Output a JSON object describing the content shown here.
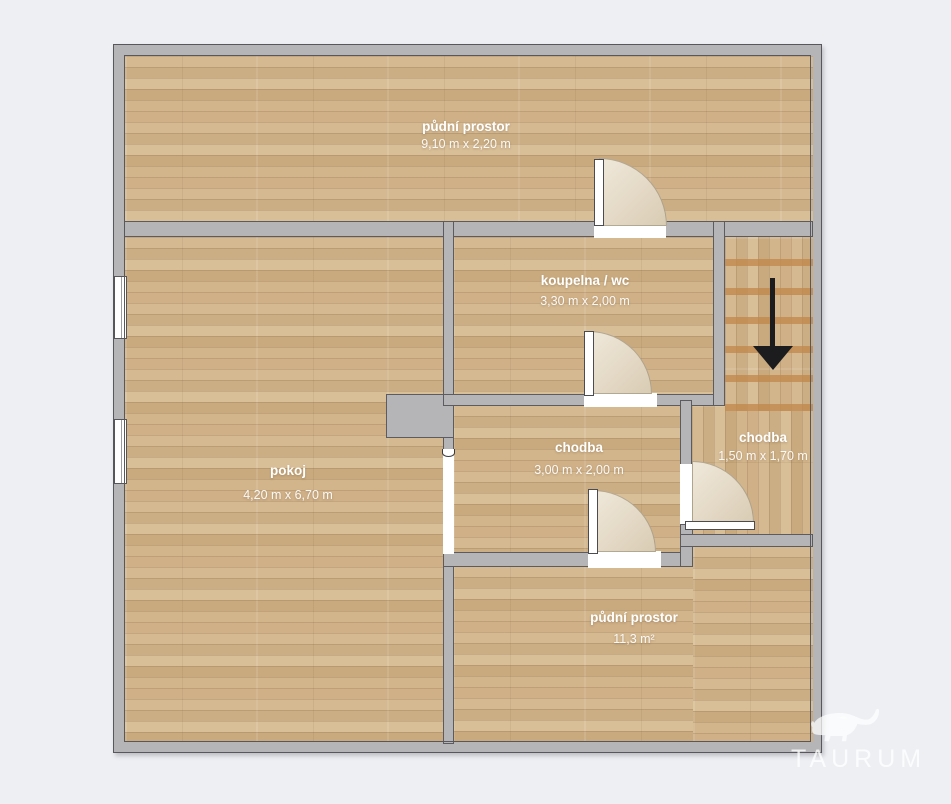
{
  "plan": {
    "rooms": [
      {
        "name": "půdní prostor",
        "dims": "9,10 m x 2,20 m"
      },
      {
        "name": "koupelna / wc",
        "dims": "3,30 m x 2,00 m"
      },
      {
        "name": "pokoj",
        "dims": "4,20 m x 6,70 m"
      },
      {
        "name": "chodba",
        "dims": "3,00 m x 2,00 m"
      },
      {
        "name": "chodba",
        "dims": "1,50 m x 1,70 m"
      },
      {
        "name": "půdní prostor",
        "dims": "11,3 m²"
      }
    ]
  },
  "watermark": {
    "brand": "TAURUM"
  },
  "colors": {
    "background": "#edeff3",
    "wall": "#b5b5b8",
    "wall_outline": "#58585c",
    "floor_base": "#cfb188",
    "stair_tread": "#c18a4d",
    "door_arc": "#e4d9c6",
    "arrow": "#1c1c1e",
    "label_text": "#ffffff"
  }
}
